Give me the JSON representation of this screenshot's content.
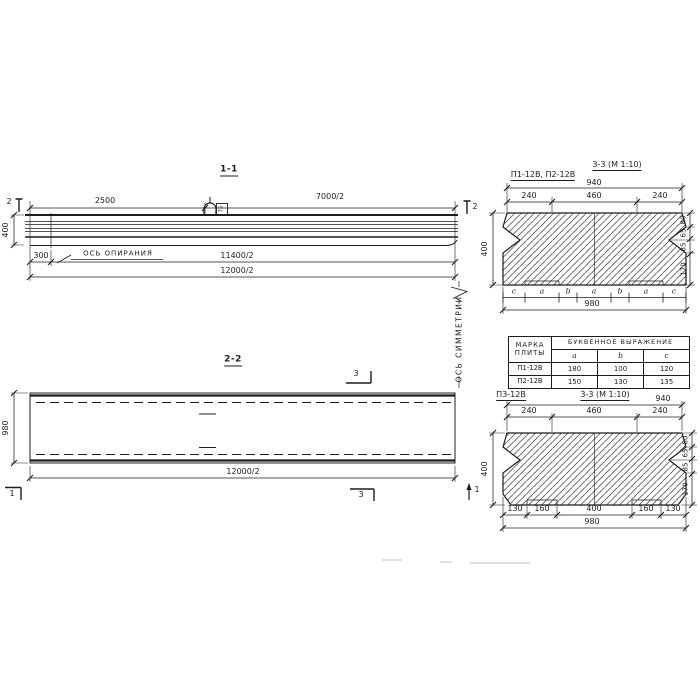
{
  "colors": {
    "background": "#ffffff",
    "line": "#1c1c1c"
  },
  "section_1_1": {
    "title": "1-1",
    "dim_2500": "2500",
    "dim_7000": "7000/2",
    "dim_11400": "11400/2",
    "dim_12000": "12000/2",
    "dim_height": "400",
    "dim_300": "300",
    "support_axis_label": "ОСЬ ОПИРАНИЯ",
    "cut_mark_left": "2",
    "cut_mark_right": "2",
    "loop_label": "75"
  },
  "section_2_2": {
    "title": "2-2",
    "dim_width": "980",
    "dim_12000": "12000/2",
    "cut_mark_3_top": "3",
    "cut_mark_3_bottom": "3",
    "cut_mark_1_left": "1",
    "cut_mark_1_right": "1"
  },
  "symmetry_axis_label": "ОСЬ СИММЕТРИИ",
  "section_3_3_top": {
    "title": "3-3 (М 1:10)",
    "marks_label": "П1-12В, П2-12В",
    "dim_940": "940",
    "dim_240_left": "240",
    "dim_460": "460",
    "dim_240_right": "240",
    "dim_400": "400",
    "right_chain": [
      "80",
      "65",
      "85",
      "170"
    ],
    "letter_row": [
      "c",
      "a",
      "b",
      "a",
      "b",
      "a",
      "c"
    ],
    "dim_980": "980"
  },
  "table": {
    "col1_header": "МАРКА ПЛИТЫ",
    "group_header": "БУКВЕННОЕ ВЫРАЖЕНИЕ",
    "columns": [
      "a",
      "b",
      "c"
    ],
    "rows": [
      {
        "mark": "П1-12В",
        "a": "180",
        "b": "100",
        "c": "120"
      },
      {
        "mark": "П2-12В",
        "a": "150",
        "b": "130",
        "c": "135"
      }
    ]
  },
  "section_3_3_bottom": {
    "mark_label": "П3-12В",
    "title": "3-3 (М 1:10)",
    "dim_940": "940",
    "dim_240_left": "240",
    "dim_460": "460",
    "dim_240_right": "240",
    "dim_400": "400",
    "right_chain": [
      "80",
      "65",
      "85",
      "170"
    ],
    "bottom_chain": [
      "130",
      "160",
      "400",
      "160",
      "130"
    ],
    "dim_980": "980"
  }
}
